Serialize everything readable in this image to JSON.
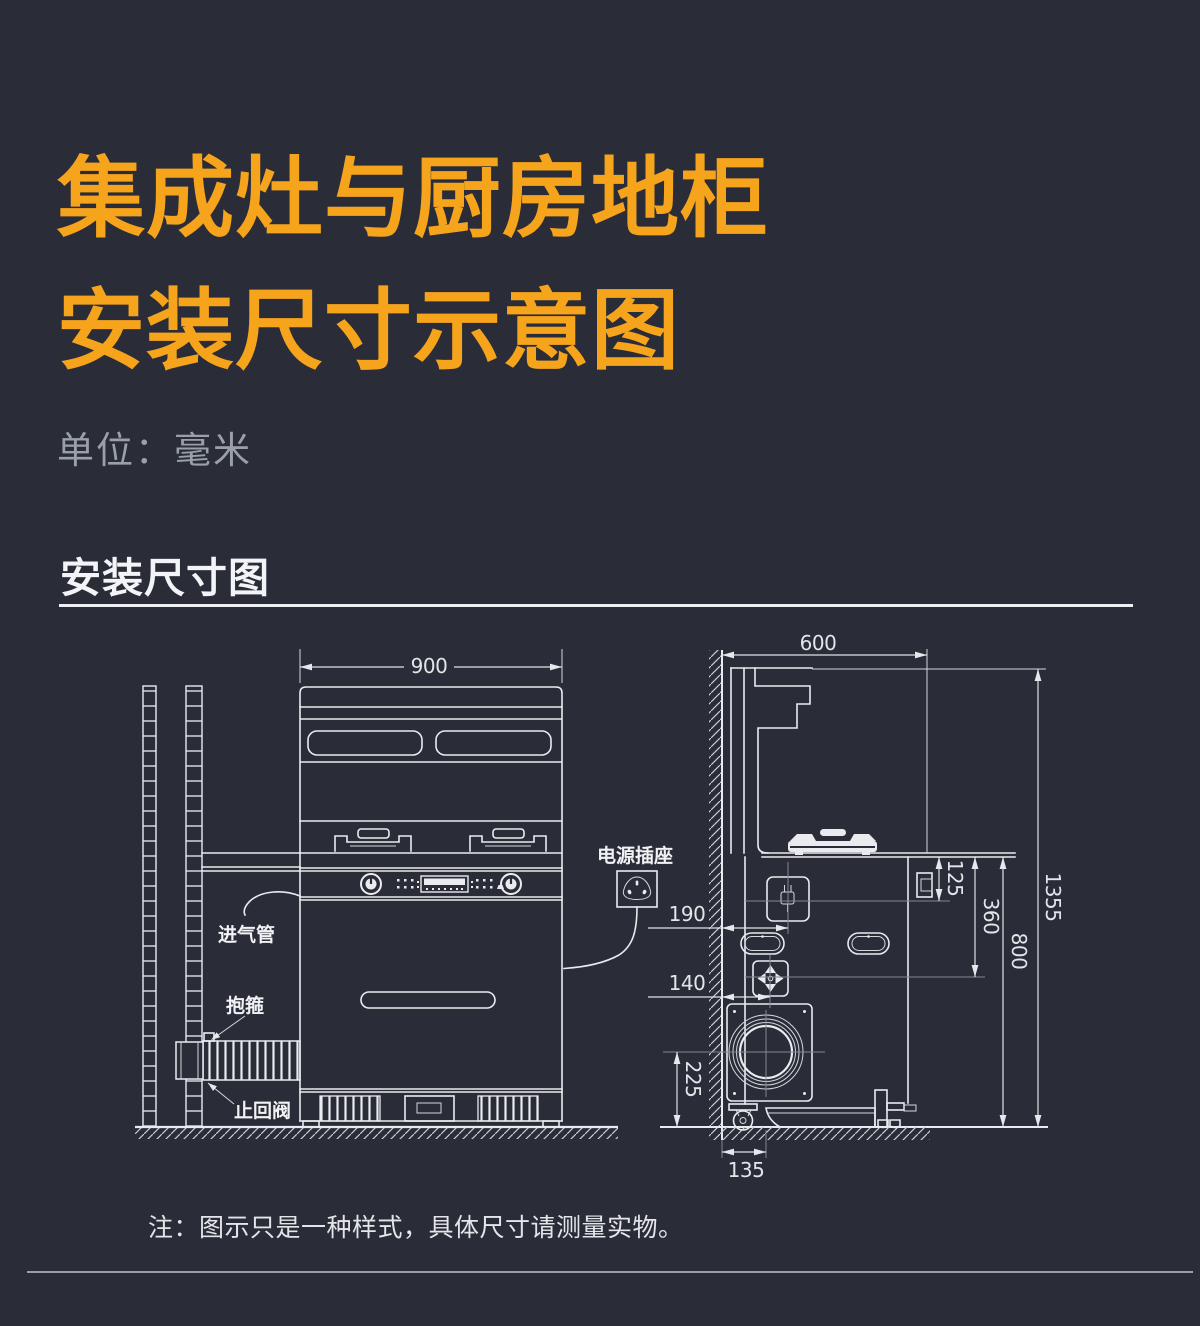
{
  "page": {
    "title_line1": "集成灶与厨房地柜",
    "title_line2": "安装尺寸示意图",
    "unit_label": "单位：毫米",
    "section_heading": "安装尺寸图",
    "note": "注：图示只是一种样式，具体尺寸请测量实物。"
  },
  "diagram": {
    "front_view": {
      "labels": {
        "gas_inlet_pipe": "进气管",
        "clamp": "抱箍",
        "check_valve": "止回阀",
        "power_socket": "电源插座"
      },
      "dims": {
        "stove_width": "900"
      }
    },
    "side_view": {
      "dims": {
        "depth": "600",
        "counter_to_socket": "125",
        "counter_to_gas_valve": "360",
        "counter_height": "800",
        "total_height": "1355",
        "wall_to_socket": "190",
        "wall_to_gas_valve": "140",
        "floor_to_fan_center": "225",
        "wall_to_fan_center": "135"
      }
    },
    "colors": {
      "background": "#2a2d38",
      "accent_orange": "#F7A41D",
      "line": "#e9ebee",
      "muted_text": "#9aa0a9"
    }
  }
}
